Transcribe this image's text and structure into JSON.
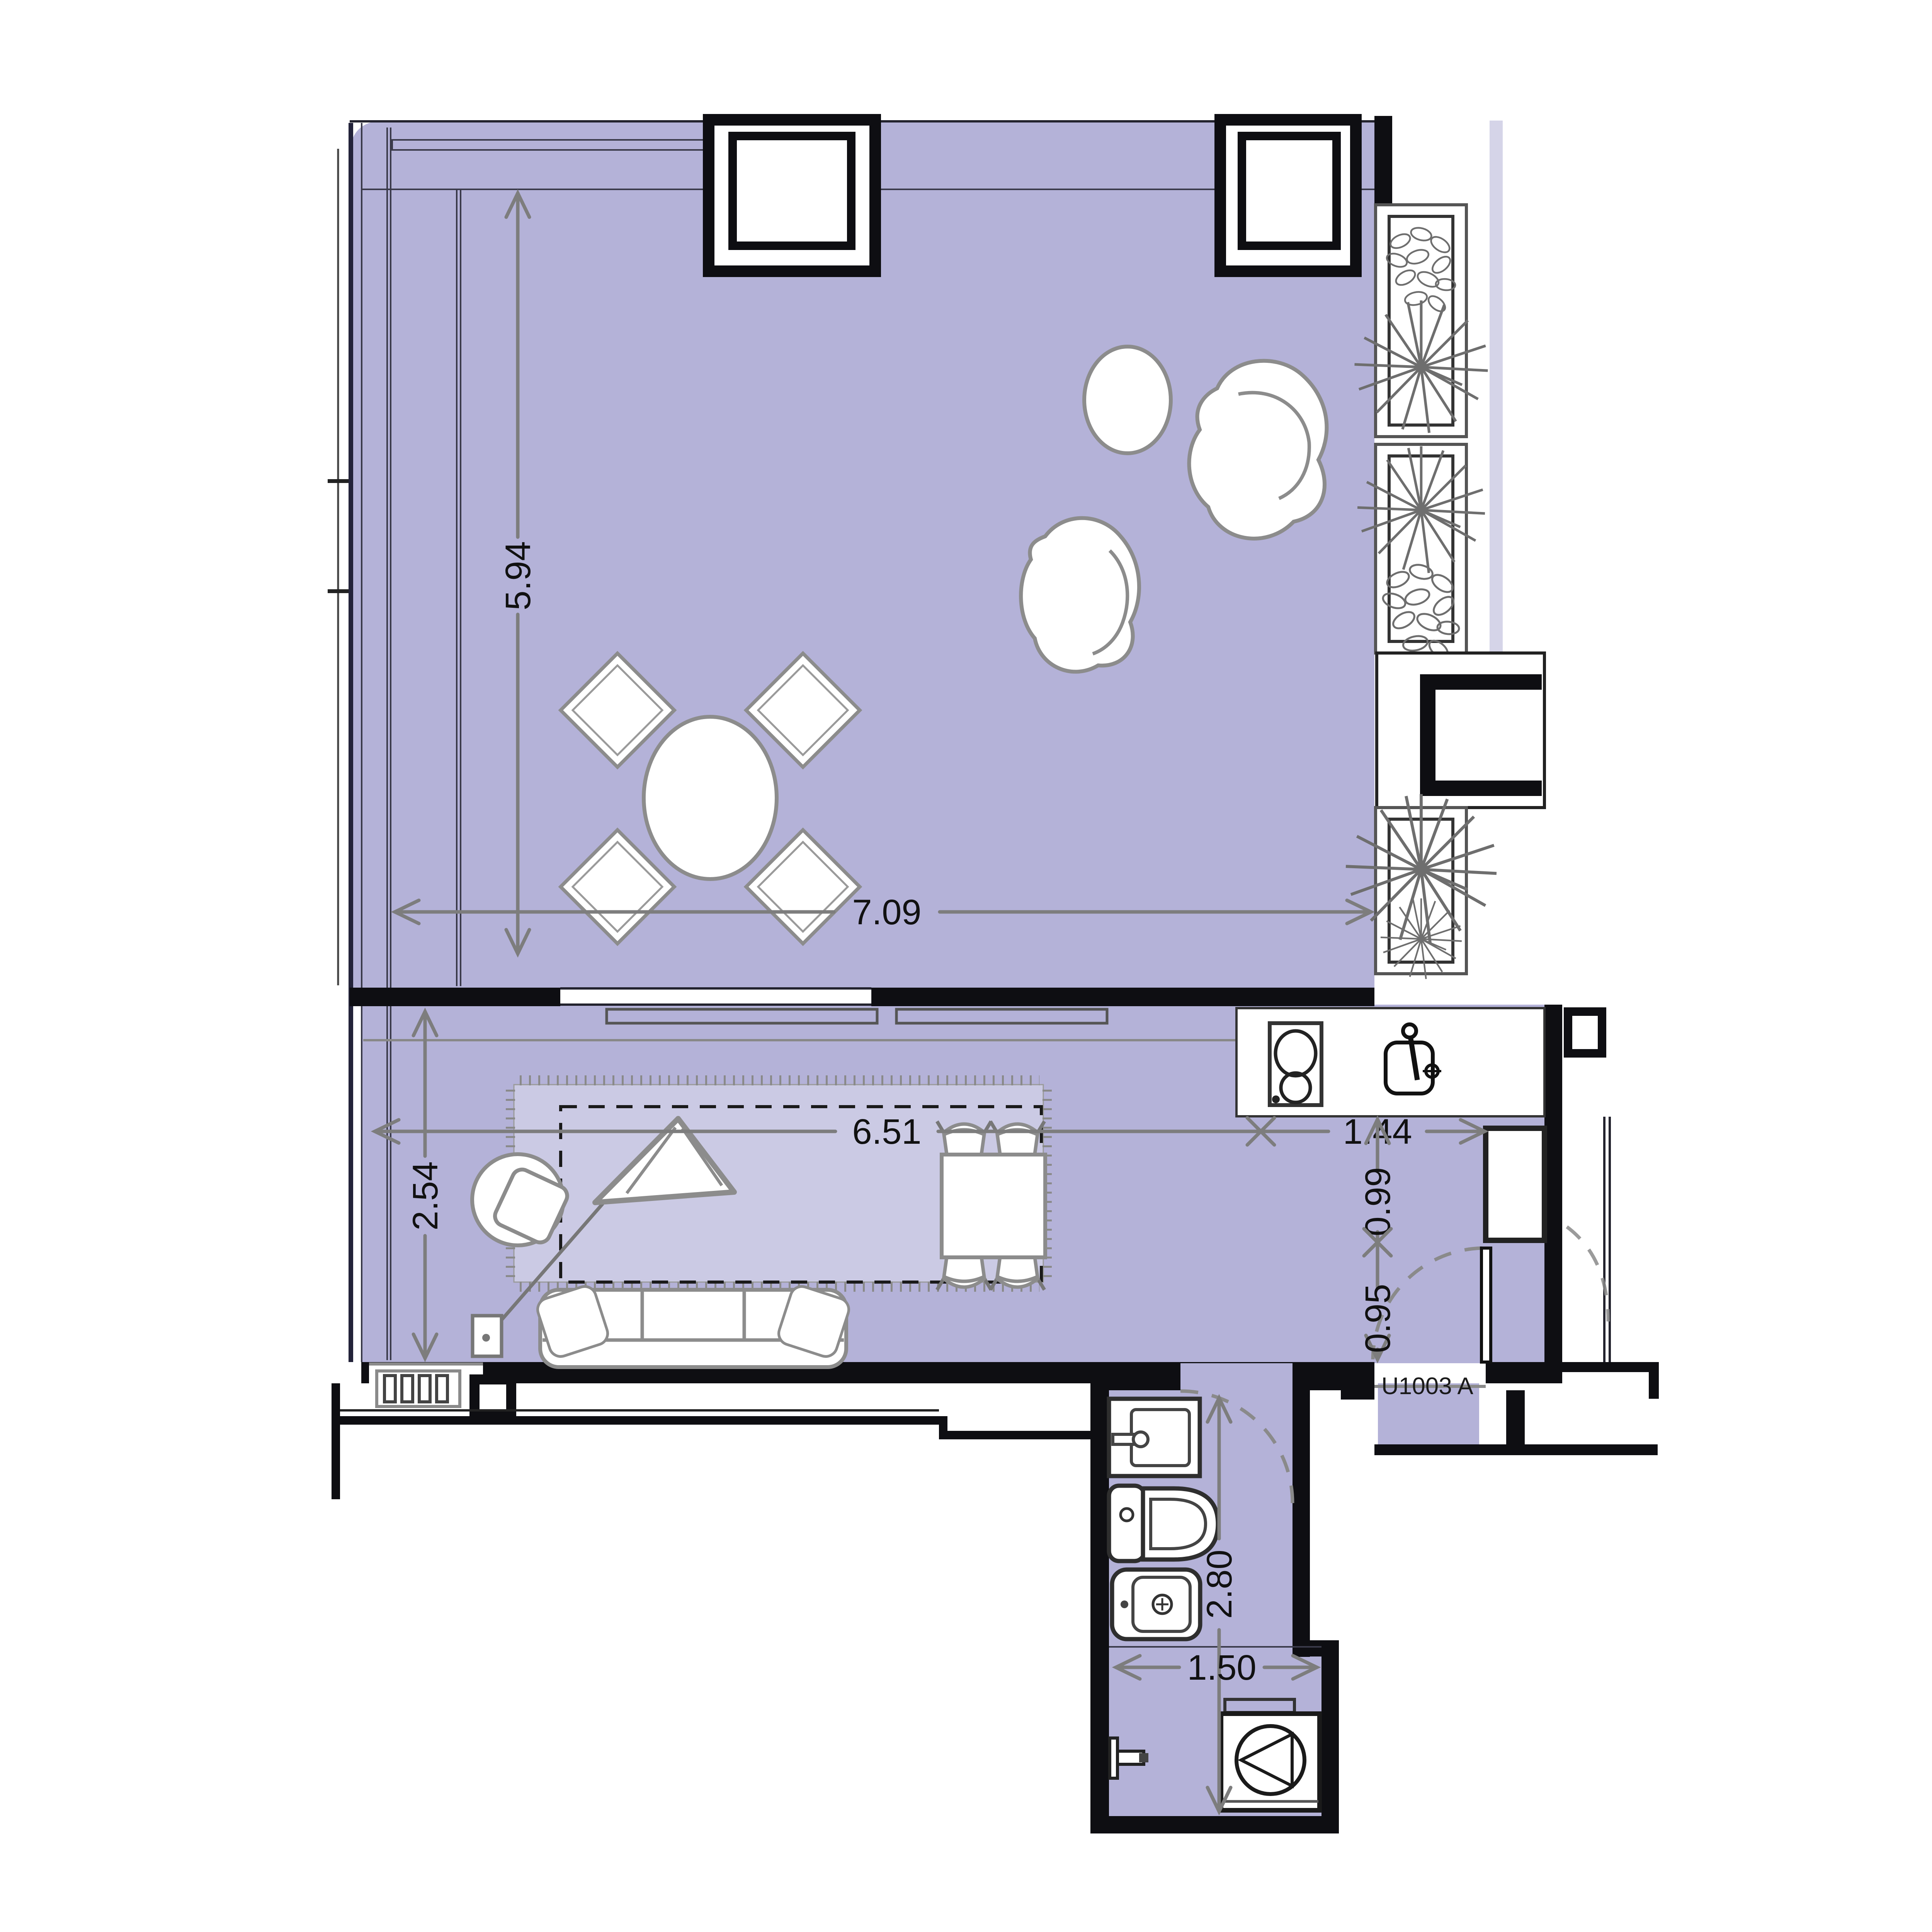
{
  "unit": {
    "label": "U1003 A"
  },
  "dims": {
    "terrace_depth": "5.94",
    "terrace_width": "7.09",
    "living_width": "6.51",
    "living_depth": "2.54",
    "kitchen_width": "1.44",
    "kitchen_return": "0.99",
    "entry_width": "0.95",
    "bathroom_depth": "2.80",
    "shower_width": "1.50"
  },
  "colors": {
    "floor": "#b4b2d8",
    "rug": "#cbcae4",
    "wall": "#0e0e12",
    "dimension_line": "#7d7d7d",
    "furniture_outline": "#8c8c8c",
    "text": "#111111"
  },
  "icons": {
    "plants": "planter-plant-icon",
    "cooktop": "cooktop-icon",
    "sink": "kitchen-sink-icon",
    "washer": "washing-machine-icon",
    "shower": "shower-head-icon"
  }
}
